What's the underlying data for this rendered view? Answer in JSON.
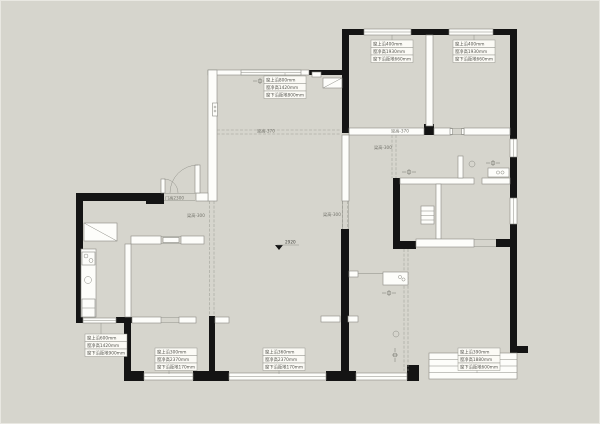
{
  "plan": {
    "colors": {
      "background": "#d6d5cd",
      "wall": "#141414",
      "line": "#8b8b84",
      "annotation_text": "#55554f"
    },
    "window_annotations": [
      {
        "position": "top-left-room",
        "lines": [
          "窗上沿800mm",
          "窗净高1420mm",
          "窗下沿距地800mm"
        ]
      },
      {
        "position": "top-middle-room",
        "lines": [
          "窗上沿400mm",
          "窗净高1930mm",
          "窗下沿距地660mm"
        ]
      },
      {
        "position": "top-right-room",
        "lines": [
          "窗上沿400mm",
          "窗净高1930mm",
          "窗下沿距地660mm"
        ]
      },
      {
        "position": "bottom-left",
        "lines": [
          "窗上沿600mm",
          "窗净高1420mm",
          "窗下沿距地900mm"
        ]
      },
      {
        "position": "bottom-mid-left",
        "lines": [
          "窗上沿300mm",
          "窗净高2370mm",
          "窗下沿距地170mm"
        ]
      },
      {
        "position": "bottom-mid-right",
        "lines": [
          "窗上沿360mm",
          "窗净高2370mm",
          "窗下沿距地170mm"
        ]
      },
      {
        "position": "bottom-right",
        "lines": [
          "窗上沿390mm",
          "窗净高1880mm",
          "窗下沿距地600mm"
        ]
      }
    ],
    "beam_labels": [
      "梁高-370",
      "梁高-370",
      "梁高-300",
      "梁高-300",
      "梁高-300"
    ],
    "door_height_label": "门高2300",
    "floor_level_label": "2920"
  }
}
